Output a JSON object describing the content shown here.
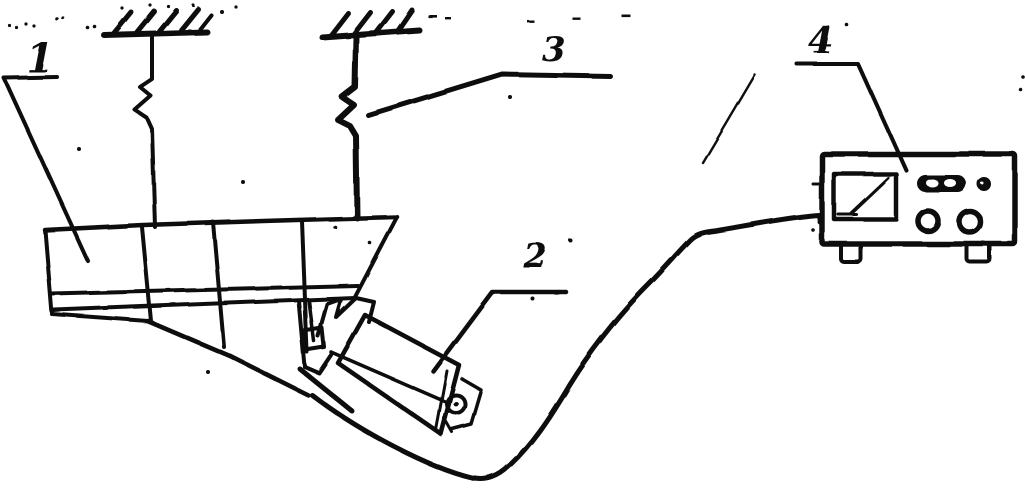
{
  "figure": {
    "type": "hand-drawn experimental setup schematic",
    "background_color": "#ffffff",
    "ink_color": "#101010",
    "labels": {
      "part1": "1",
      "part2": "2",
      "part3": "3",
      "part4": "4"
    }
  }
}
